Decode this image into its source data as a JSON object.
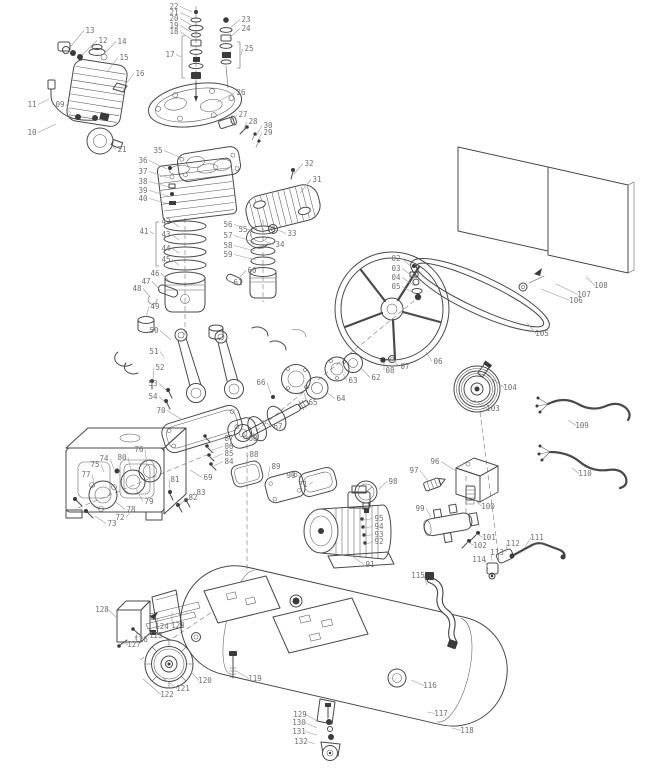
{
  "figure": {
    "kind": "exploded-parts-diagram",
    "subject": "belt-driven air compressor assembly",
    "canvas": {
      "width": 646,
      "height": 768
    },
    "colors": {
      "background": "#ffffff",
      "line": "#4a4a4a",
      "label": "#707070",
      "leader": "#9a9a9a",
      "dark_fill": "#3b3b3b"
    },
    "components": [
      "intake-muffler",
      "drain-hose",
      "valve-hardware-stacks",
      "cylinder-head",
      "air-filter",
      "head-gasket",
      "cylinder-block",
      "fin-cover",
      "exhaust-tube",
      "piston-ring-sets",
      "pistons",
      "wrist-pins",
      "connecting-rods",
      "crankcase",
      "crankcase-gasket",
      "bearing-seals",
      "crankshaft",
      "bearing-plate",
      "side-covers",
      "flywheel",
      "hub-flanges",
      "v-belt",
      "motor-pulley",
      "belt-guard-grille",
      "power-cables",
      "electric-motor",
      "pressure-gauge",
      "pressure-switch",
      "outlet-manifold",
      "check-valve-piping",
      "flexible-discharge-hose",
      "air-tank",
      "mounting-plates",
      "wheel",
      "caster-foot",
      "handle-bracket-parts"
    ]
  },
  "parts_labels": [
    [
      "02",
      396,
      261,
      413,
      268
    ],
    [
      "03",
      396,
      271,
      414,
      277
    ],
    [
      "04",
      396,
      280,
      415,
      286
    ],
    [
      "05",
      396,
      289,
      416,
      294
    ],
    [
      "06",
      438,
      364,
      426,
      352
    ],
    [
      "07",
      405,
      369,
      394,
      361
    ],
    [
      "08",
      390,
      373,
      384,
      362
    ],
    [
      "09",
      60,
      107,
      71,
      114
    ],
    [
      "10",
      32,
      135,
      56,
      124
    ],
    [
      "11",
      32,
      107,
      49,
      99
    ],
    [
      "12",
      103,
      43,
      82,
      55
    ],
    [
      "13",
      90,
      33,
      71,
      46
    ],
    [
      "14",
      122,
      44,
      103,
      55
    ],
    [
      "15",
      124,
      60,
      107,
      72
    ],
    [
      "16",
      140,
      76,
      124,
      86
    ],
    [
      "17",
      170,
      57,
      181,
      57
    ],
    [
      "18",
      174,
      34,
      191,
      39
    ],
    [
      "19",
      174,
      28,
      191,
      32
    ],
    [
      "20",
      174,
      21,
      191,
      25
    ],
    [
      "21",
      174,
      15,
      192,
      18
    ],
    [
      "22",
      174,
      9,
      192,
      12
    ],
    [
      "23",
      246,
      22,
      229,
      29
    ],
    [
      "24",
      246,
      31,
      229,
      38
    ],
    [
      "25",
      249,
      51,
      241,
      55
    ],
    [
      "26",
      241,
      95,
      217,
      102
    ],
    [
      "27",
      243,
      117,
      230,
      122
    ],
    [
      "28",
      253,
      124,
      243,
      131
    ],
    [
      "30",
      268,
      128,
      256,
      136
    ],
    [
      "29",
      268,
      135,
      257,
      142
    ],
    [
      "31",
      317,
      182,
      300,
      193
    ],
    [
      "32",
      309,
      166,
      294,
      174
    ],
    [
      "33",
      292,
      236,
      278,
      230
    ],
    [
      "34",
      280,
      247,
      265,
      241
    ],
    [
      "21",
      122,
      152,
      110,
      144
    ],
    [
      "35",
      158,
      153,
      182,
      158
    ],
    [
      "36",
      143,
      163,
      167,
      169
    ],
    [
      "37",
      143,
      174,
      169,
      178
    ],
    [
      "38",
      143,
      184,
      169,
      187
    ],
    [
      "39",
      143,
      193,
      169,
      196
    ],
    [
      "40",
      143,
      201,
      169,
      204
    ],
    [
      "41",
      144,
      234,
      154,
      234
    ],
    [
      "42",
      166,
      224,
      179,
      227
    ],
    [
      "43",
      166,
      237,
      179,
      240
    ],
    [
      "44",
      166,
      251,
      179,
      253
    ],
    [
      "45",
      166,
      262,
      179,
      265
    ],
    [
      "46",
      155,
      276,
      169,
      281
    ],
    [
      "47",
      146,
      284,
      160,
      290
    ],
    [
      "48",
      137,
      291,
      150,
      297
    ],
    [
      "49",
      155,
      309,
      146,
      317
    ],
    [
      "50",
      154,
      333,
      171,
      340
    ],
    [
      "51",
      154,
      354,
      164,
      357
    ],
    [
      "52",
      160,
      370,
      153,
      380
    ],
    [
      "53",
      153,
      386,
      167,
      391
    ],
    [
      "54",
      153,
      399,
      165,
      402
    ],
    [
      "55",
      243,
      232,
      252,
      236
    ],
    [
      "56",
      228,
      227,
      253,
      231
    ],
    [
      "57",
      228,
      238,
      254,
      242
    ],
    [
      "58",
      228,
      248,
      255,
      251
    ],
    [
      "59",
      228,
      257,
      256,
      260
    ],
    [
      "60",
      252,
      273,
      240,
      277
    ],
    [
      "61",
      238,
      285,
      227,
      280
    ],
    [
      "62",
      376,
      380,
      361,
      368
    ],
    [
      "63",
      353,
      383,
      343,
      374
    ],
    [
      "64",
      341,
      401,
      326,
      392
    ],
    [
      "65",
      313,
      405,
      303,
      390
    ],
    [
      "66",
      261,
      385,
      271,
      394
    ],
    [
      "67",
      278,
      429,
      262,
      420
    ],
    [
      "68",
      253,
      441,
      243,
      432
    ],
    [
      "69",
      208,
      480,
      190,
      470
    ],
    [
      "70",
      161,
      413,
      183,
      420
    ],
    [
      "90",
      291,
      478,
      300,
      477
    ],
    [
      "71",
      303,
      487,
      313,
      482
    ],
    [
      "72",
      120,
      520,
      131,
      511
    ],
    [
      "73",
      112,
      526,
      95,
      516
    ],
    [
      "74",
      104,
      461,
      114,
      469
    ],
    [
      "75",
      95,
      467,
      104,
      472
    ],
    [
      "76",
      139,
      452,
      147,
      465
    ],
    [
      "77",
      86,
      477,
      95,
      487
    ],
    [
      "78",
      131,
      512,
      116,
      502
    ],
    [
      "79",
      149,
      504,
      136,
      489
    ],
    [
      "80",
      122,
      460,
      131,
      470
    ],
    [
      "81",
      175,
      482,
      170,
      490
    ],
    [
      "82",
      193,
      500,
      180,
      505
    ],
    [
      "83",
      201,
      495,
      187,
      501
    ],
    [
      "84",
      229,
      464,
      214,
      466
    ],
    [
      "85",
      229,
      456,
      213,
      458
    ],
    [
      "86",
      229,
      449,
      212,
      450
    ],
    [
      "87",
      229,
      441,
      210,
      442
    ],
    [
      "88",
      254,
      457,
      247,
      464
    ],
    [
      "89",
      276,
      469,
      268,
      477
    ],
    [
      "91",
      370,
      567,
      352,
      556
    ],
    [
      "92",
      379,
      544,
      367,
      544
    ],
    [
      "93",
      379,
      537,
      366,
      536
    ],
    [
      "94",
      379,
      529,
      365,
      528
    ],
    [
      "95",
      379,
      521,
      364,
      520
    ],
    [
      "96",
      435,
      464,
      456,
      471
    ],
    [
      "97",
      414,
      473,
      428,
      481
    ],
    [
      "98",
      393,
      484,
      379,
      489
    ],
    [
      "99",
      420,
      511,
      431,
      517
    ],
    [
      "100",
      488,
      509,
      473,
      498
    ],
    [
      "101",
      489,
      540,
      477,
      534
    ],
    [
      "102",
      480,
      548,
      468,
      542
    ],
    [
      "103",
      493,
      411,
      474,
      400
    ],
    [
      "104",
      510,
      390,
      487,
      375
    ],
    [
      "105",
      542,
      336,
      527,
      323
    ],
    [
      "106",
      576,
      303,
      541,
      289
    ],
    [
      "107",
      584,
      297,
      556,
      284
    ],
    [
      "108",
      601,
      288,
      586,
      277
    ],
    [
      "109",
      582,
      428,
      568,
      420
    ],
    [
      "110",
      585,
      476,
      572,
      468
    ],
    [
      "111",
      537,
      540,
      525,
      547
    ],
    [
      "112",
      513,
      546,
      506,
      552
    ],
    [
      "113",
      497,
      555,
      492,
      561
    ],
    [
      "114",
      479,
      562,
      488,
      569
    ],
    [
      "115",
      418,
      578,
      427,
      585
    ],
    [
      "116",
      430,
      688,
      411,
      680
    ],
    [
      "117",
      441,
      716,
      427,
      712
    ],
    [
      "118",
      467,
      733,
      452,
      728
    ],
    [
      "119",
      255,
      681,
      236,
      671
    ],
    [
      "120",
      205,
      683,
      191,
      672
    ],
    [
      "121",
      183,
      691,
      159,
      675
    ],
    [
      "122",
      167,
      697,
      143,
      679
    ],
    [
      "123",
      178,
      628,
      172,
      612
    ],
    [
      "124",
      162,
      629,
      158,
      618
    ],
    [
      "125",
      156,
      638,
      149,
      628
    ],
    [
      "126",
      141,
      642,
      137,
      633
    ],
    [
      "127",
      134,
      647,
      124,
      643
    ],
    [
      "128",
      102,
      612,
      116,
      617
    ],
    [
      "129",
      300,
      717,
      317,
      721
    ],
    [
      "130",
      299,
      725,
      317,
      728
    ],
    [
      "131",
      299,
      734,
      317,
      735
    ],
    [
      "132",
      301,
      744,
      315,
      744
    ]
  ]
}
